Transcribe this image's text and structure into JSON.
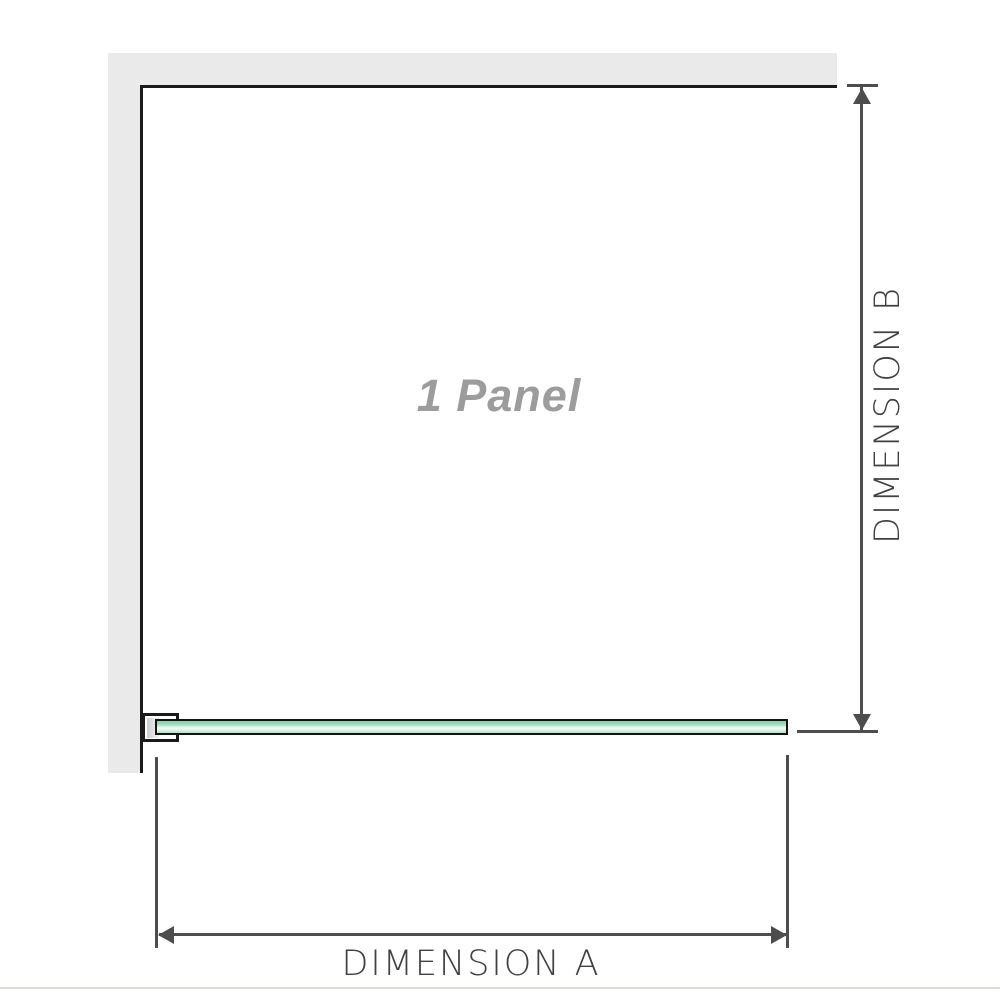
{
  "diagram": {
    "title": "1 Panel",
    "dimension_a": {
      "label": "DIMENSION A"
    },
    "dimension_b": {
      "label": "DIMENSION B"
    }
  },
  "colors": {
    "wall": "#eaeaea",
    "outline": "#1a1a1a",
    "dimension_line": "#4d4d4d",
    "label_text": "#414141",
    "watermark_text": "#9c9c9c",
    "glass_green_dark": "#87d1a9",
    "glass_green_light": "#eef9f2",
    "bottom_rule": "#e0ddd8"
  }
}
